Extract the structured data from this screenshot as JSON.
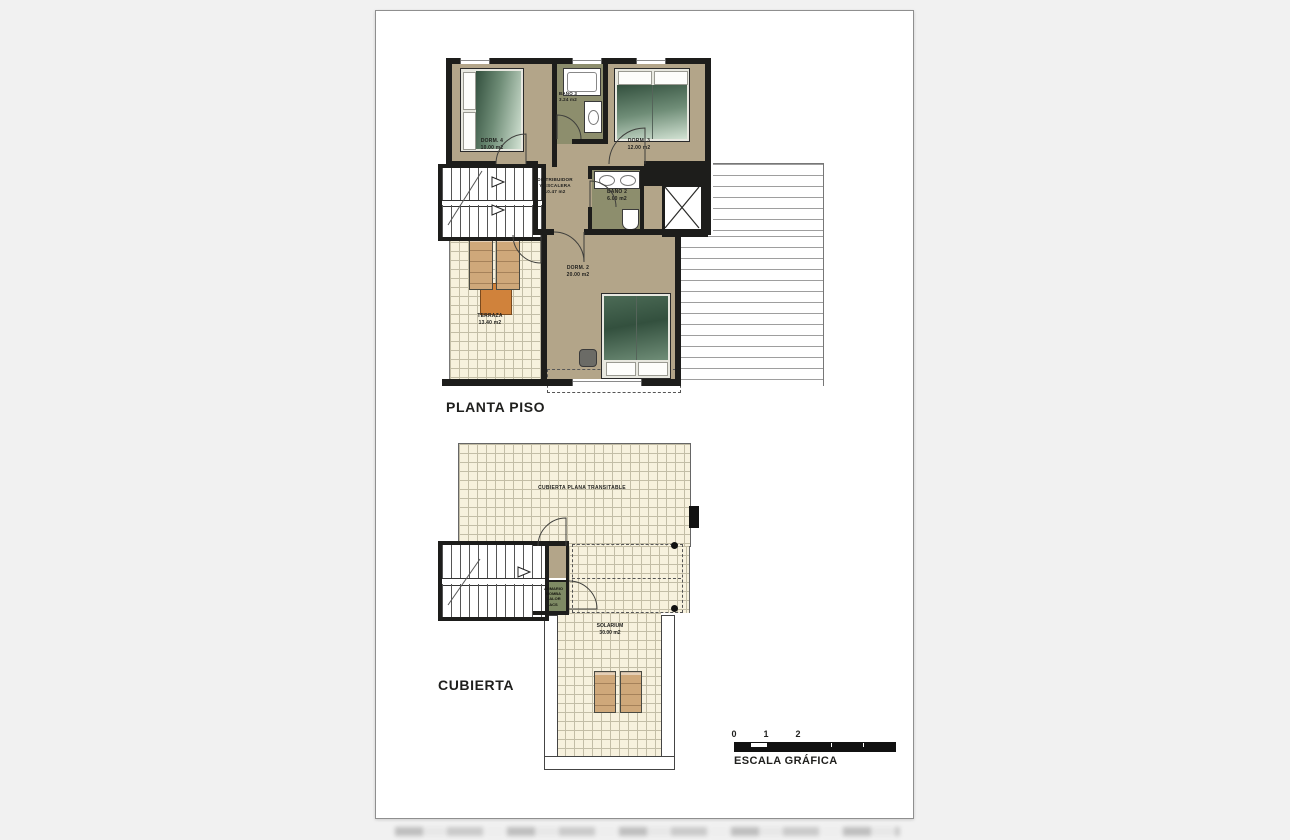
{
  "plans": {
    "planta_piso": {
      "title": "PLANTA PISO",
      "rooms": {
        "dorm4": {
          "name": "DORM. 4",
          "area": "10.00 m2"
        },
        "bano3": {
          "name": "BAÑO 3",
          "area": "3.24 m2"
        },
        "dorm3": {
          "name": "DORM. 3",
          "area": "12.00 m2"
        },
        "distribuidor": {
          "name": "DISTRIBUIDOR",
          "name2": "Y ESCALERA",
          "area": "10.47 m2"
        },
        "bano2": {
          "name": "BAÑO 2",
          "area": "6.00 m2"
        },
        "dorm2": {
          "name": "DORM. 2",
          "area": "20.00 m2"
        },
        "terraza": {
          "name": "TERRAZA",
          "area": "13.40 m2"
        }
      }
    },
    "cubierta": {
      "title": "CUBIERTA",
      "labels": {
        "roof_deck": "CUBIERTA PLANA TRANSITABLE",
        "armario_line1": "ARMARIO",
        "armario_line2": "BOMBA CALOR",
        "armario_line3": "ACS",
        "solarium_name": "SOLARIUM",
        "solarium_area": "30.00 m2"
      }
    }
  },
  "scale_bar": {
    "ticks": [
      "0",
      "1",
      "2",
      "5"
    ],
    "caption": "ESCALA GRÁFICA"
  },
  "colors": {
    "wall": "#1d1d1b",
    "floor_tan": "#b3a589",
    "floor_olive": "#8d8e6d",
    "tile_cream": "#f7f1dd",
    "tile_line": "#c3bda6",
    "bed_dark": "#33503e",
    "bed_light": "#d2e2d3",
    "lounger": "#cfa87a",
    "table_orange": "#d0823b",
    "page_bg": "#f1f1f1",
    "sheet_bg": "#ffffff"
  }
}
